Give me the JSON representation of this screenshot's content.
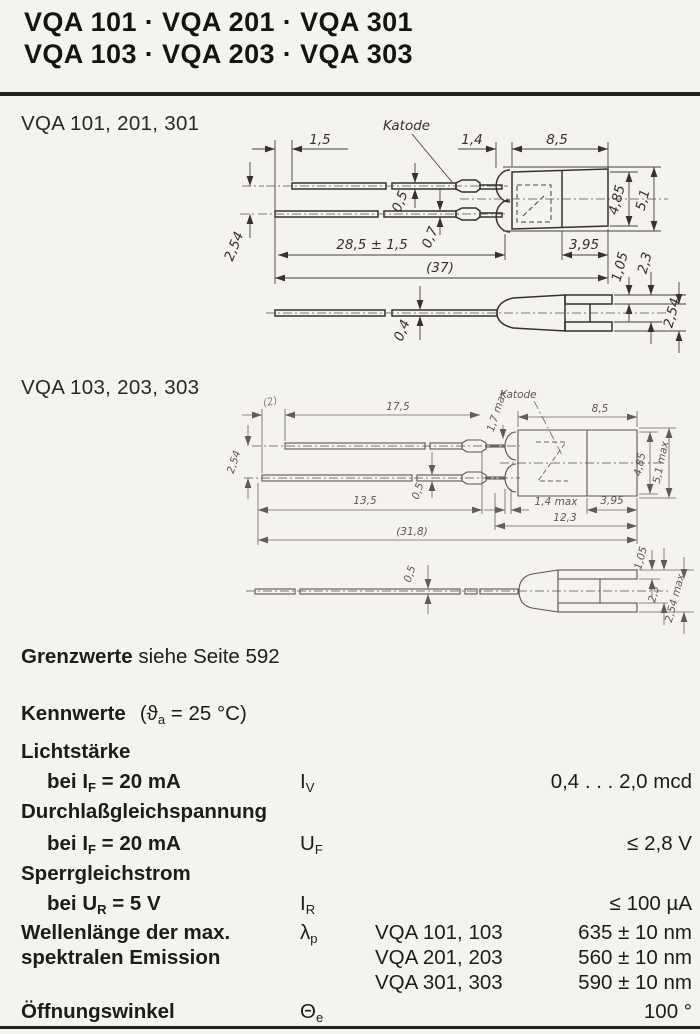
{
  "header": {
    "title_line1": "VQA 101 · VQA 201 · VQA 301",
    "title_line2": "VQA 103 · VQA 203 · VQA 303"
  },
  "drawing1": {
    "section_label": "VQA 101, 201, 301",
    "katode": "Katode",
    "dims": {
      "lead_offset": "1,5",
      "flange_width": "1,4",
      "body_length": "8,5",
      "lead_thickness_top": "0,5",
      "lead_thickness_bottom": "0,7",
      "lead_pitch": "2,54",
      "lead_length": "28,5 ± 1,5",
      "total_length": "(37)",
      "body_back_length": "3,95",
      "body_dia_inner": "4,85",
      "body_dia_outer": "5,1",
      "tab_offset": "1,05",
      "tab_span": "2,3",
      "tab_pitch": "2,54",
      "lead_thickness_side": "0,4"
    }
  },
  "drawing2": {
    "section_label": "VQA 103, 203, 303",
    "katode": "Katode",
    "dims": {
      "lead_offset": "(2)",
      "lead_length_top": "17,5",
      "crimp_width": "1,7 max",
      "body_length": "8,5",
      "lead_pitch": "2,54",
      "lead_thickness": "0,5",
      "lead_length_bottom": "13,5",
      "flange_width": "1,4 max",
      "body_back_length": "3,95",
      "body_total": "12,3",
      "total_length": "(31,8)",
      "body_dia_inner": "4,85",
      "body_dia_outer": "5,1 max",
      "lead_thickness_side": "0,5",
      "tab_offset": "1,05",
      "tab_span": "2,3",
      "tab_pitch": "2,54 max"
    }
  },
  "grenzwerte": {
    "label_bold": "Grenzwerte",
    "label_rest": "siehe Seite 592"
  },
  "kennwerte": {
    "heading_bold": "Kennwerte",
    "heading_cond_pre": "(ϑ",
    "heading_cond_sub": "a",
    "heading_cond_post": " = 25 °C)",
    "rows": {
      "lichtstaerke": {
        "group": "Lichtstärke",
        "cond_pre": "bei I",
        "cond_sub": "F",
        "cond_post": " = 20 mA",
        "sym": "I",
        "sym_sub": "V",
        "value": "0,4 . . . 2,0 mcd"
      },
      "durchlass": {
        "group": "Durchlaßgleichspannung",
        "cond_pre": "bei I",
        "cond_sub": "F",
        "cond_post": " = 20 mA",
        "sym": "U",
        "sym_sub": "F",
        "value": "≤ 2,8 V"
      },
      "sperr": {
        "group": "Sperrgleichstrom",
        "cond_pre": "bei U",
        "cond_sub": "R",
        "cond_post": " = 5 V",
        "sym": "I",
        "sym_sub": "R",
        "value": "≤ 100 µA"
      },
      "wellenlaenge": {
        "group_line1": "Wellenlänge der max.",
        "group_line2": "spektralen Emission",
        "sym": "λ",
        "sym_sub": "p",
        "variants": [
          {
            "types": "VQA 101, 103",
            "value": "635 ± 10 nm"
          },
          {
            "types": "VQA 201, 203",
            "value": "560 ± 10 nm"
          },
          {
            "types": "VQA 301, 303",
            "value": "590 ± 10 nm"
          }
        ]
      },
      "oeffnung": {
        "group": "Öffnungswinkel",
        "sym": "Θ",
        "sym_sub": "e",
        "value": "100 °"
      }
    }
  }
}
